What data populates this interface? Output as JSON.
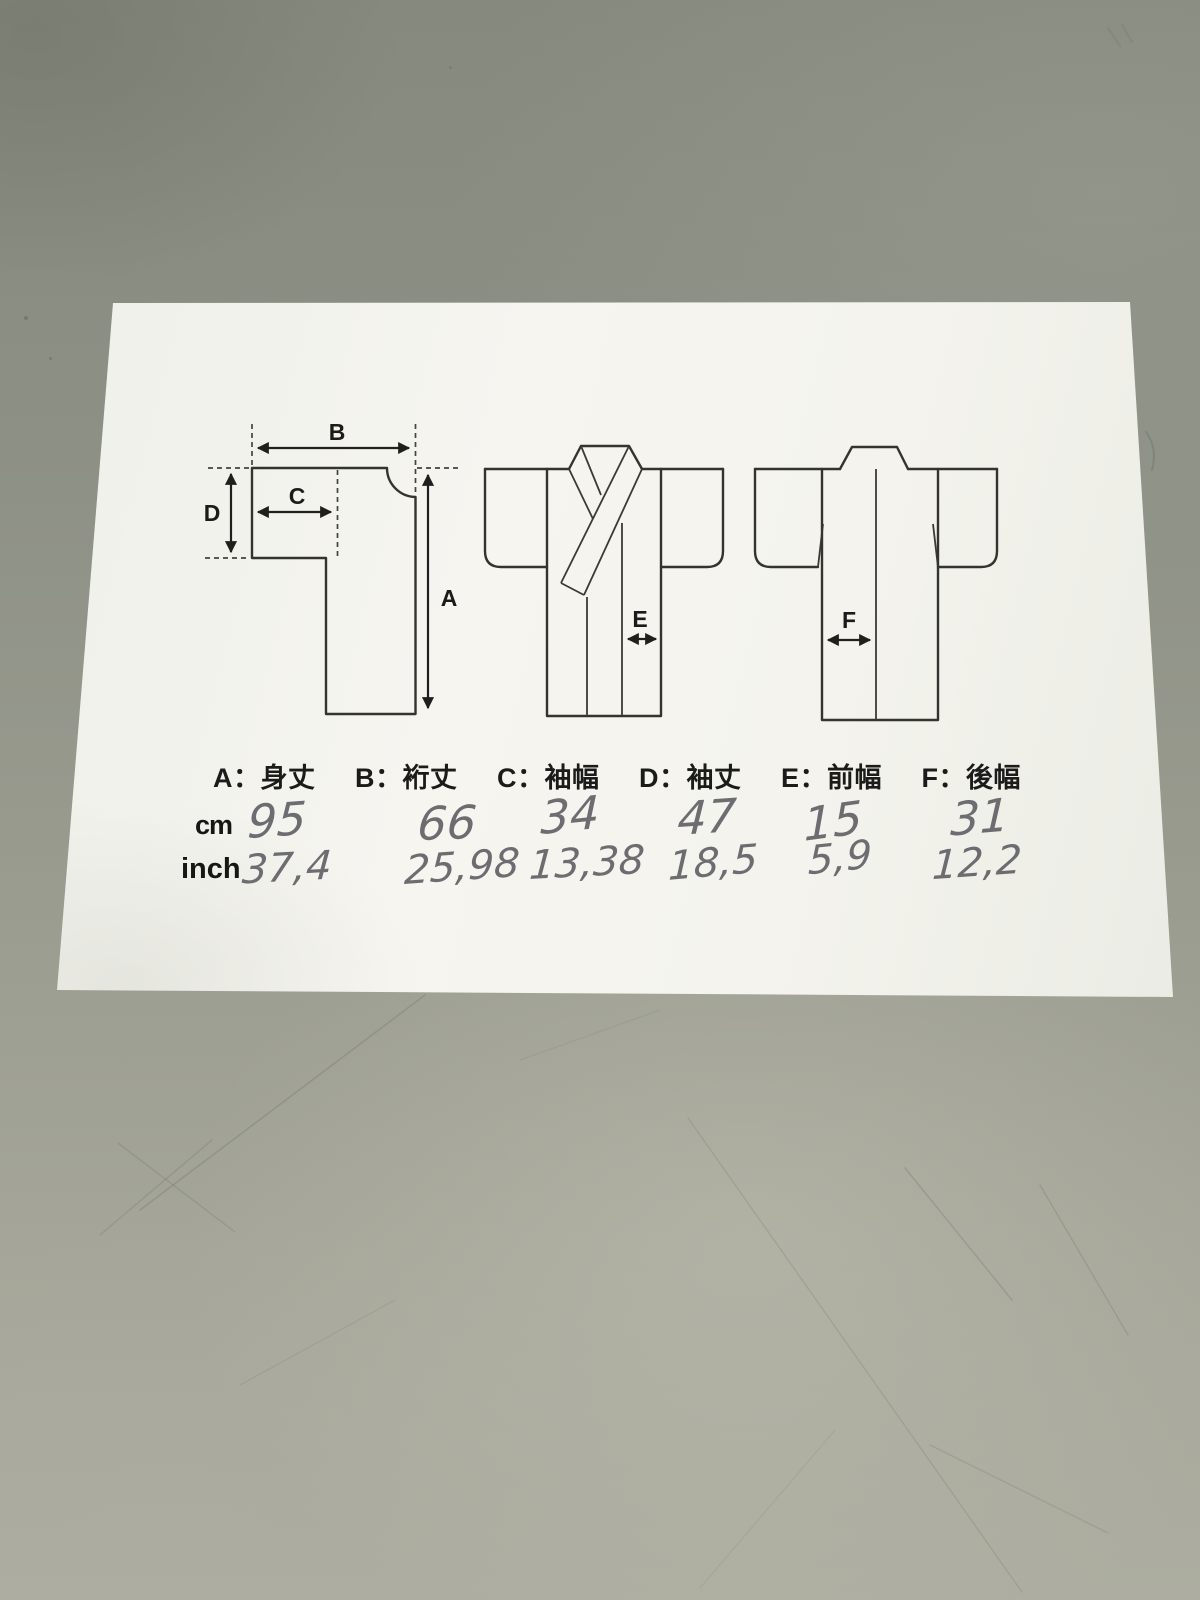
{
  "palette": {
    "table_dark": "#868a7e",
    "table_light": "#adaea1",
    "paper": "#f4f3ee",
    "print_ink": "#33332f",
    "pencil": "#56565c"
  },
  "legend": {
    "items": [
      "A：身丈",
      "B：裄丈",
      "C：袖幅",
      "D：袖丈",
      "E：前幅",
      "F：後幅"
    ]
  },
  "diagram_labels": {
    "A": "A",
    "B": "B",
    "C": "C",
    "D": "D",
    "E": "E",
    "F": "F"
  },
  "table": {
    "unit_cm": "cm",
    "unit_inch": "inch",
    "cm_values": [
      "95",
      "66",
      "34",
      "47",
      "15",
      "31"
    ],
    "inch_values": [
      "37,4",
      "25,98",
      "13,38",
      "18,5",
      "5,9",
      "12,2"
    ]
  }
}
